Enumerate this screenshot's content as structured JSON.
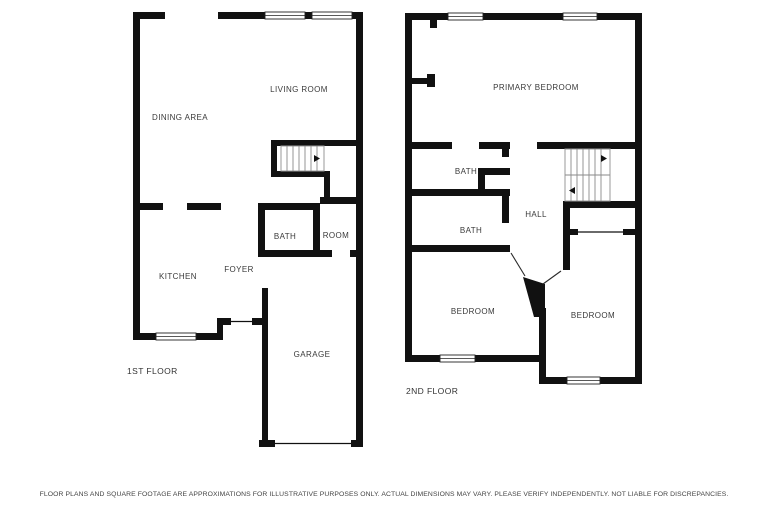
{
  "page": {
    "background": "#ffffff",
    "wall_color": "#111111",
    "label_color": "#3a3a3a"
  },
  "floor1": {
    "name_label": "1ST FLOOR",
    "rooms": {
      "living_room": "LIVING ROOM",
      "dining_area": "DINING AREA",
      "kitchen": "KITCHEN",
      "foyer": "FOYER",
      "bath": "BATH",
      "room": "ROOM",
      "garage": "GARAGE"
    }
  },
  "floor2": {
    "name_label": "2ND FLOOR",
    "rooms": {
      "primary_bedroom": "PRIMARY BEDROOM",
      "bath_upper": "BATH",
      "bath_lower": "BATH",
      "hall": "HALL",
      "bedroom_left": "BEDROOM",
      "bedroom_right": "BEDROOM"
    }
  },
  "disclaimer": "FLOOR PLANS AND SQUARE FOOTAGE ARE APPROXIMATIONS FOR ILLUSTRATIVE PURPOSES ONLY. ACTUAL DIMENSIONS MAY VARY. PLEASE VERIFY INDEPENDENTLY. NOT LIABLE FOR DISCREPANCIES."
}
